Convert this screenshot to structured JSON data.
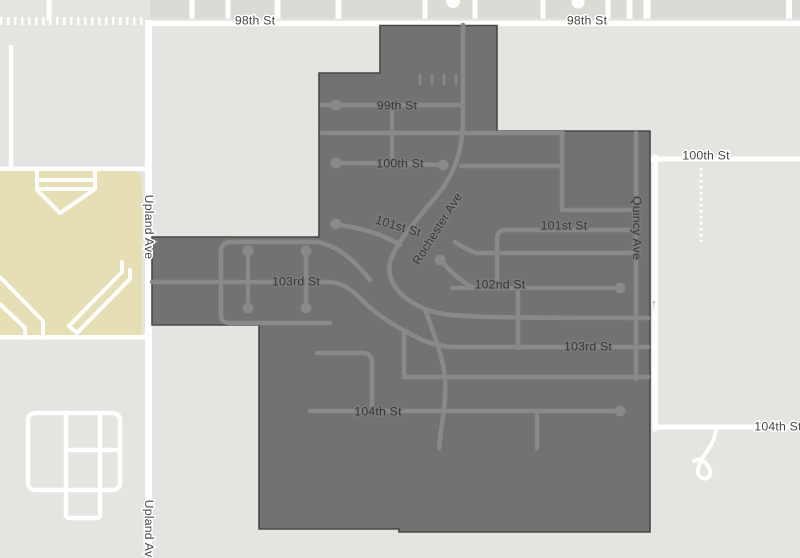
{
  "map": {
    "description": "Street map with dark selected-region overlay covering the 99th-104th St neighborhood",
    "colors": {
      "base": "#e6e4e0",
      "block": "#dcdad5",
      "road": "#ffffff",
      "park": "#e6deb4",
      "selection_fill": "#747271",
      "selection_edge": "#4a4845",
      "selection_street": "#8b8987",
      "label_outside": "#474645",
      "label_inside": "#3a3836",
      "arrow": "#a9a7a4"
    },
    "street_labels": [
      {
        "text": "98th St",
        "x": 255,
        "y": 21,
        "rot": 0,
        "zone": "outside"
      },
      {
        "text": "98th St",
        "x": 587,
        "y": 21,
        "rot": 0,
        "zone": "outside"
      },
      {
        "text": "100th St",
        "x": 706,
        "y": 156,
        "rot": 0,
        "zone": "outside"
      },
      {
        "text": "104th St",
        "x": 778,
        "y": 427,
        "rot": 0,
        "zone": "outside"
      },
      {
        "text": "Upland Ave",
        "x": 148,
        "y": 227,
        "rot": 90,
        "zone": "outside"
      },
      {
        "text": "Upland Ave",
        "x": 148,
        "y": 532,
        "rot": 90,
        "zone": "outside"
      },
      {
        "text": "99th St",
        "x": 397,
        "y": 106,
        "rot": 0,
        "zone": "inside"
      },
      {
        "text": "100th St",
        "x": 400,
        "y": 164,
        "rot": 0,
        "zone": "inside"
      },
      {
        "text": "101st St",
        "x": 398,
        "y": 227,
        "rot": 17,
        "zone": "inside"
      },
      {
        "text": "Rochester Ave",
        "x": 438,
        "y": 229,
        "rot": -58,
        "zone": "inside"
      },
      {
        "text": "101st St",
        "x": 564,
        "y": 226,
        "rot": 0,
        "zone": "inside"
      },
      {
        "text": "103rd St",
        "x": 296,
        "y": 282,
        "rot": 0,
        "zone": "inside"
      },
      {
        "text": "102nd St",
        "x": 500,
        "y": 285,
        "rot": 0,
        "zone": "inside"
      },
      {
        "text": "103rd St",
        "x": 588,
        "y": 347,
        "rot": 0,
        "zone": "inside"
      },
      {
        "text": "104th St",
        "x": 378,
        "y": 412,
        "rot": 0,
        "zone": "inside"
      },
      {
        "text": "Quincy Ave",
        "x": 636,
        "y": 228,
        "rot": 90,
        "zone": "inside"
      }
    ],
    "one_way_arrow": {
      "glyph": "↑",
      "x": 654,
      "y": 308
    }
  }
}
